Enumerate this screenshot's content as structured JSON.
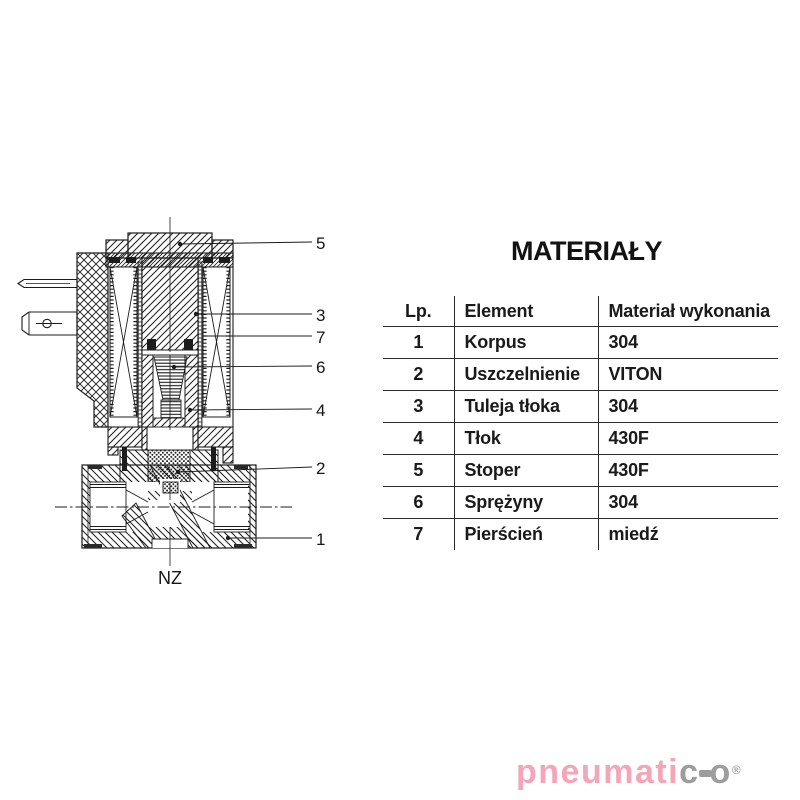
{
  "title": "MATERIAŁY",
  "table": {
    "headers": [
      "Lp.",
      "Element",
      "Materiał wykonania"
    ],
    "rows": [
      [
        "1",
        "Korpus",
        "304"
      ],
      [
        "2",
        "Uszczelnienie",
        "VITON"
      ],
      [
        "3",
        "Tuleja tłoka",
        "304"
      ],
      [
        "4",
        "Tłok",
        "430F"
      ],
      [
        "5",
        "Stoper",
        "430F"
      ],
      [
        "6",
        "Sprężyny",
        "304"
      ],
      [
        "7",
        "Pierścień",
        "miedź"
      ]
    ]
  },
  "diagram": {
    "type": "solenoid-valve-cross-section",
    "callouts": [
      "5",
      "3",
      "7",
      "6",
      "4",
      "2",
      "1"
    ],
    "bottom_label": "NZ"
  },
  "logo": {
    "part_pink": "pneumati",
    "part_gray_c": "c",
    "part_gray_o": "o",
    "registered": "®",
    "color_pink": "#f3a6b9",
    "color_gray": "#9d9d9d"
  }
}
